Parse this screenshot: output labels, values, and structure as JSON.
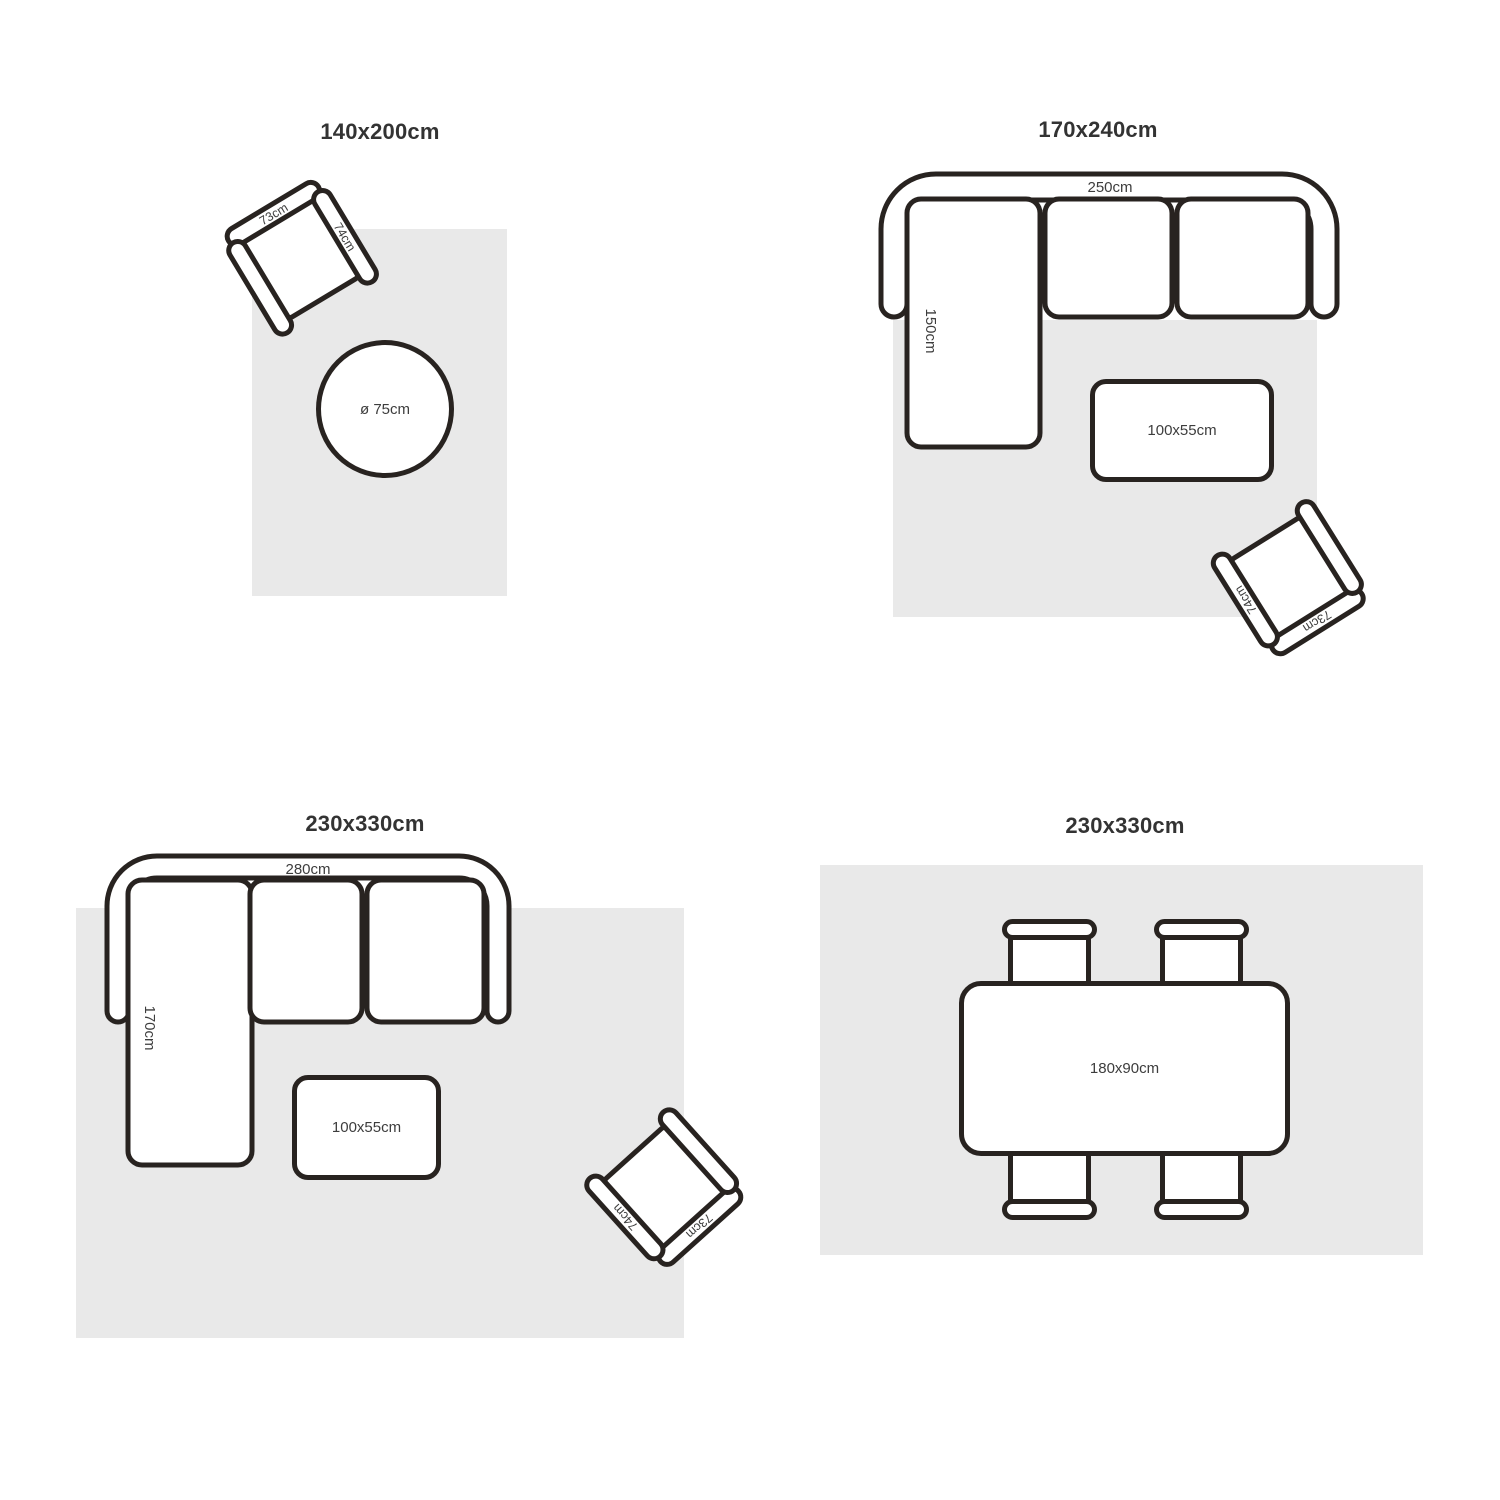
{
  "colors": {
    "background": "#ffffff",
    "rug_fill": "#e9e9e9",
    "stroke": "#282320",
    "label_text": "#3d3d3d",
    "title_text": "#333333"
  },
  "armchair": {
    "back_label": "73cm",
    "side_label": "74cm"
  },
  "quadrants": {
    "q1": {
      "title": "140x200cm",
      "round_table_label": "ø 75cm"
    },
    "q2": {
      "title": "170x240cm",
      "sofa_width_label": "250cm",
      "chaise_label": "150cm",
      "coffee_table_label": "100x55cm"
    },
    "q3": {
      "title": "230x330cm",
      "sofa_width_label": "280cm",
      "chaise_label": "170cm",
      "coffee_table_label": "100x55cm"
    },
    "q4": {
      "title": "230x330cm",
      "dining_table_label": "180x90cm"
    }
  }
}
